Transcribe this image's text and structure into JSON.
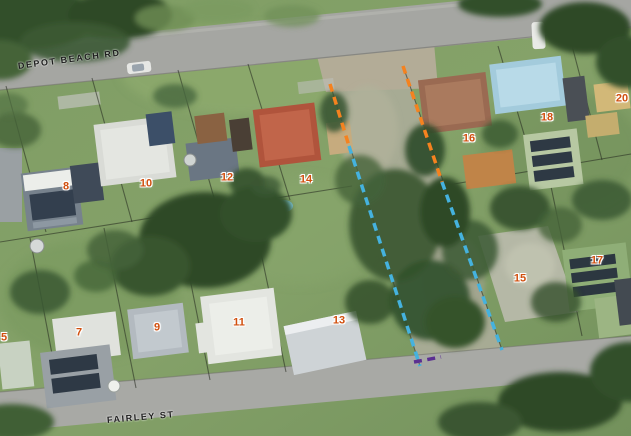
{
  "map": {
    "kind": "aerial-photo-lot-map",
    "streets": [
      {
        "name": "DEPOT BEACH RD",
        "x": 18,
        "y": 62,
        "angle": -7.5
      },
      {
        "name": "FAIRLEY ST",
        "x": 107,
        "y": 416,
        "angle": -5
      }
    ],
    "lots": [
      {
        "label": "8",
        "x": 66,
        "y": 187
      },
      {
        "label": "10",
        "x": 146,
        "y": 184
      },
      {
        "label": "12",
        "x": 227,
        "y": 178
      },
      {
        "label": "14",
        "x": 306,
        "y": 180
      },
      {
        "label": "16",
        "x": 469,
        "y": 139
      },
      {
        "label": "18",
        "x": 547,
        "y": 118
      },
      {
        "label": "20",
        "x": 622,
        "y": 99
      },
      {
        "label": "5",
        "x": 4,
        "y": 338
      },
      {
        "label": "7",
        "x": 79,
        "y": 333
      },
      {
        "label": "9",
        "x": 157,
        "y": 328
      },
      {
        "label": "11",
        "x": 239,
        "y": 323
      },
      {
        "label": "13",
        "x": 339,
        "y": 321
      },
      {
        "label": "15",
        "x": 520,
        "y": 279
      },
      {
        "label": "17",
        "x": 597,
        "y": 261
      }
    ],
    "boundary_overlay": {
      "colors": {
        "orange": "#F5821F",
        "blue": "#45B2DE",
        "purple": "#5B2F91"
      },
      "dash": "8 5.5",
      "width": 3.5,
      "segments": [
        {
          "color": "orange",
          "x1": 330,
          "y1": 84,
          "x2": 349,
          "y2": 146
        },
        {
          "color": "blue",
          "x1": 349,
          "y1": 146,
          "x2": 420,
          "y2": 366
        },
        {
          "color": "orange",
          "x1": 403,
          "y1": 66,
          "x2": 442,
          "y2": 182
        },
        {
          "color": "blue",
          "x1": 442,
          "y1": 182,
          "x2": 502,
          "y2": 350
        },
        {
          "color": "purple",
          "x1": 414,
          "y1": 362,
          "x2": 441,
          "y2": 357
        }
      ]
    },
    "label_style": {
      "lot_color": "#D14F0E",
      "street_color": "#1E1E1E"
    }
  }
}
